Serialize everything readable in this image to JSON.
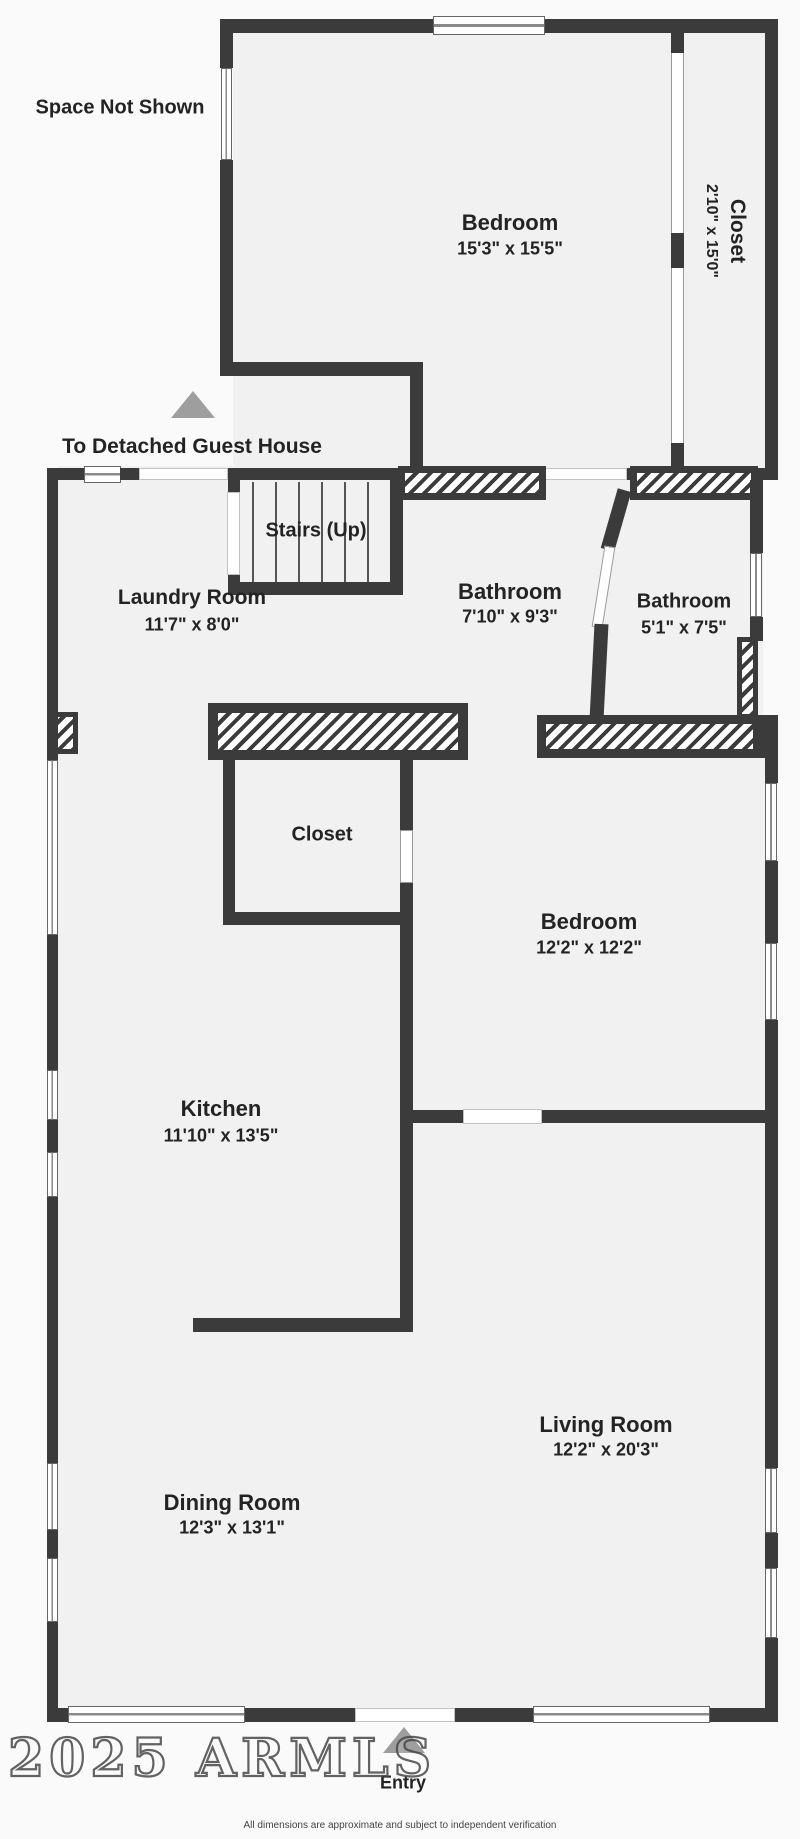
{
  "colors": {
    "wall": "#3b3b3b",
    "floor": "#f1f1f1",
    "outside": "#fafafa",
    "arrow_gray": "#9e9e9e",
    "label_text": "#232323",
    "watermark_outline": "#4f4f4f"
  },
  "annotations": {
    "space_not_shown": "Space Not Shown",
    "to_guest_house": "To Detached Guest House",
    "stairs": "Stairs (Up)",
    "entry": "Entry",
    "watermark": "2025 ARMLS",
    "disclaimer": "All dimensions are approximate and subject to independent verification"
  },
  "rooms": [
    {
      "id": "bedroom-upper",
      "name": "Bedroom",
      "dims": "15'3\" x 15'5\""
    },
    {
      "id": "closet-upper",
      "name": "Closet",
      "dims": "2'10\" x 15'0\""
    },
    {
      "id": "laundry-room",
      "name": "Laundry Room",
      "dims": "11'7\" x 8'0\""
    },
    {
      "id": "bathroom-main",
      "name": "Bathroom",
      "dims": "7'10\" x 9'3\""
    },
    {
      "id": "bathroom-small",
      "name": "Bathroom",
      "dims": "5'1\" x 7'5\""
    },
    {
      "id": "closet-middle",
      "name": "Closet",
      "dims": ""
    },
    {
      "id": "bedroom-middle",
      "name": "Bedroom",
      "dims": "12'2\" x 12'2\""
    },
    {
      "id": "kitchen",
      "name": "Kitchen",
      "dims": "11'10\" x 13'5\""
    },
    {
      "id": "living-room",
      "name": "Living Room",
      "dims": "12'2\" x 20'3\""
    },
    {
      "id": "dining-room",
      "name": "Dining Room",
      "dims": "12'3\" x 13'1\""
    }
  ]
}
